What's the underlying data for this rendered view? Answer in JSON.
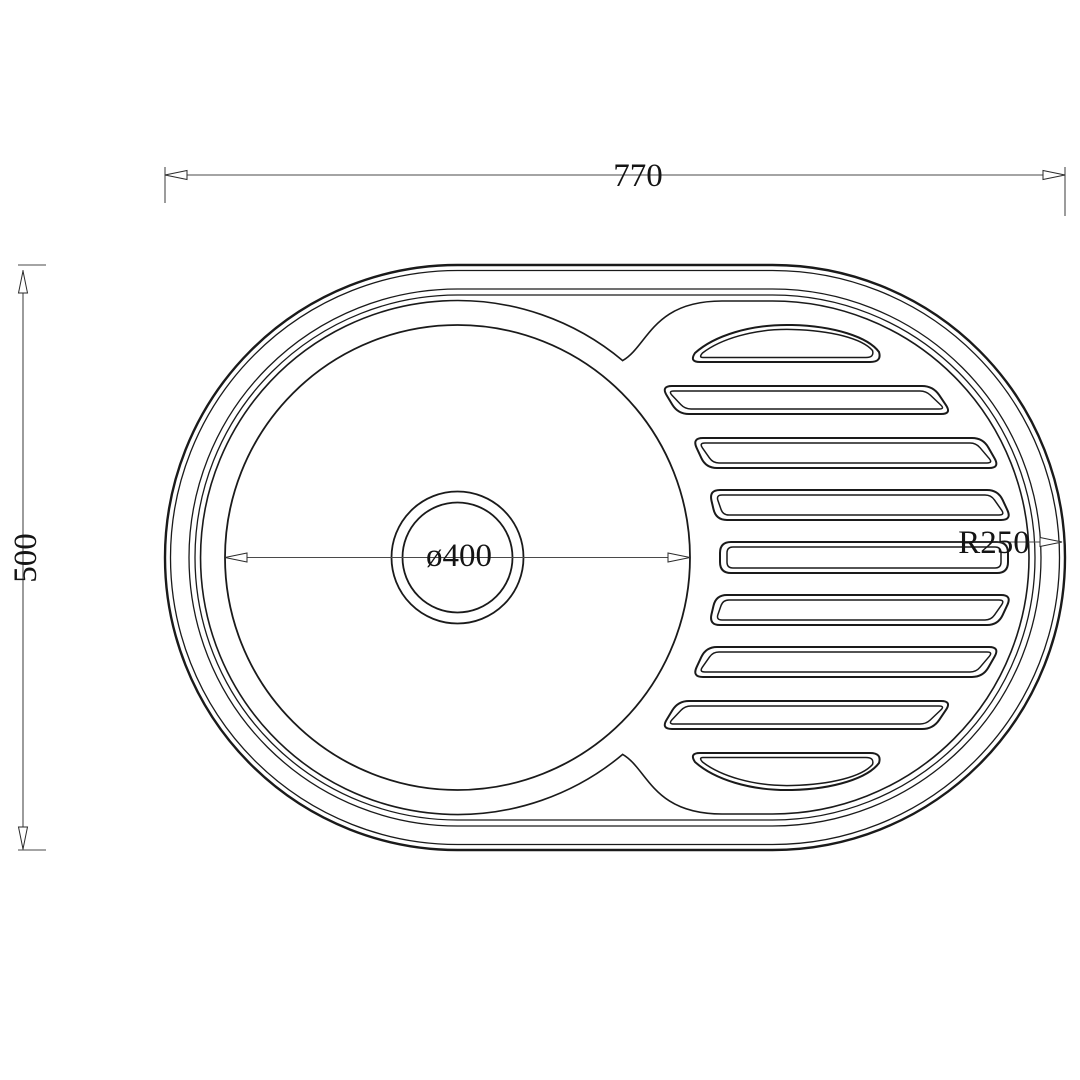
{
  "drawing": {
    "labels": {
      "overall_width": "770",
      "overall_height": "500",
      "bowl_diameter": "ø400",
      "end_radius": "R250"
    },
    "colors": {
      "part_line": "#1a1a1a",
      "dimension_line": "#4a4a4a",
      "background": "#ffffff"
    }
  }
}
